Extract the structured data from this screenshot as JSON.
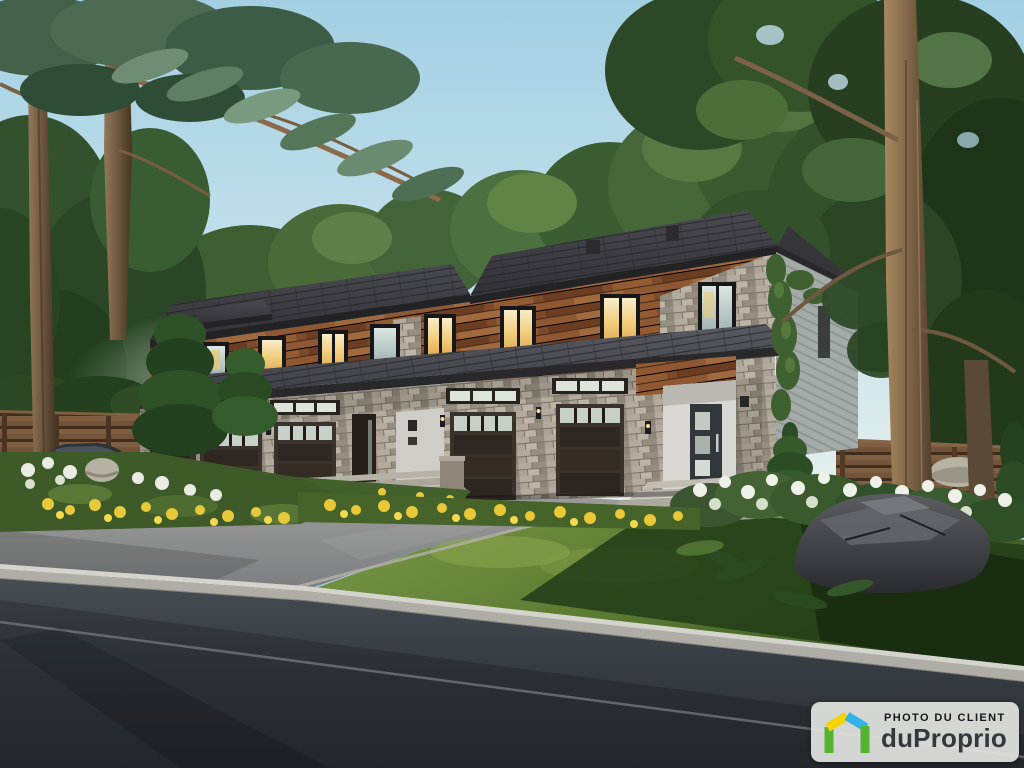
{
  "scene": {
    "type": "real-estate-architectural-rendering",
    "subject": "New modern two-storey townhouse multiplex with wood and stone facade, four dark garage doors with glass top rows, two entry doors, landscaped beds with yellow and white flowers, pine trees, silver sports car at left, grey driveway, concrete curb and dark asphalt road in the foreground, large boulder at lower right"
  },
  "watermark": {
    "label": "PHOTO DU CLIENT",
    "brand": "duProprio",
    "colors": {
      "badge_bg": "rgba(226,227,224,0.93)",
      "label_text": "#17181a",
      "brand_text": "#36393c",
      "logo_green": "#56b32f",
      "logo_yellow": "#f4d503",
      "logo_blue": "#2fb3e8"
    }
  },
  "palette": {
    "sky_top": "#a3cfe3",
    "sky_horizon": "#e9f1ec",
    "foliage_dark": "#2b4426",
    "foliage_mid": "#46663a",
    "foliage_light": "#5d7f45",
    "roof_shingle": "#3a3a3f",
    "wood_siding": "#83502f",
    "stone_veneer": "#a59d90",
    "garage_door": "#342c26",
    "white_trim": "#d8d7d3",
    "driveway": "#8f9193",
    "curb": "#d4d4cd",
    "road": "#34383e",
    "lawn": "#61803a",
    "rock": "#45464b",
    "car_silver": "#c6cbce"
  }
}
